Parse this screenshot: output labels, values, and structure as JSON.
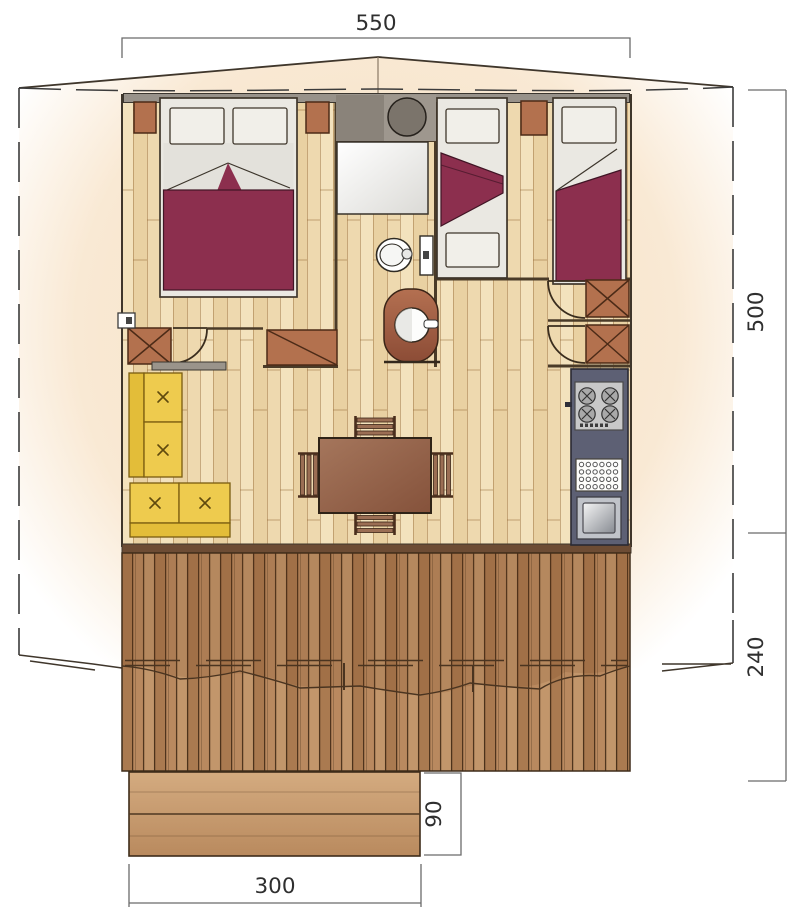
{
  "figure": {
    "type": "floor-plan",
    "subject": "tent lodge floor plan with deck and steps"
  },
  "dimensions": {
    "top_width": "550",
    "right_height": "500",
    "deck_depth": "240",
    "steps_depth": "90",
    "steps_width": "300"
  },
  "colors": {
    "line": "#3f362b",
    "wall_dark": "#4a3b28",
    "dash": "#3b3b3b",
    "canvas_inner": "#f6dfc1",
    "canvas_outer": "#ffffff",
    "floor": "#ecd5ab",
    "wall_gray": "#98928a",
    "counter_gray": "#8a837a",
    "counter_gray2": "#9e978e",
    "burgundy": "#8c2f4e",
    "sheet": "#e3e1db",
    "bedbase": "#eae8e2",
    "pillow": "#f1efe9",
    "wood": "#b3714e",
    "wood_dark": "#4c2b17",
    "sofa": "#eecb4e",
    "sofa_back": "#e3bd39",
    "sofa_line": "#7a5c10",
    "table": "#9b6e54",
    "chair": "#9b6e54",
    "kitchen": "#5d6074",
    "steel": "#c0c3c9",
    "deck_line": "#54381f",
    "bottom_wall": "#6d4c34",
    "dim_line": "#6b6b6b",
    "dim_text": "#2f2f2f"
  }
}
